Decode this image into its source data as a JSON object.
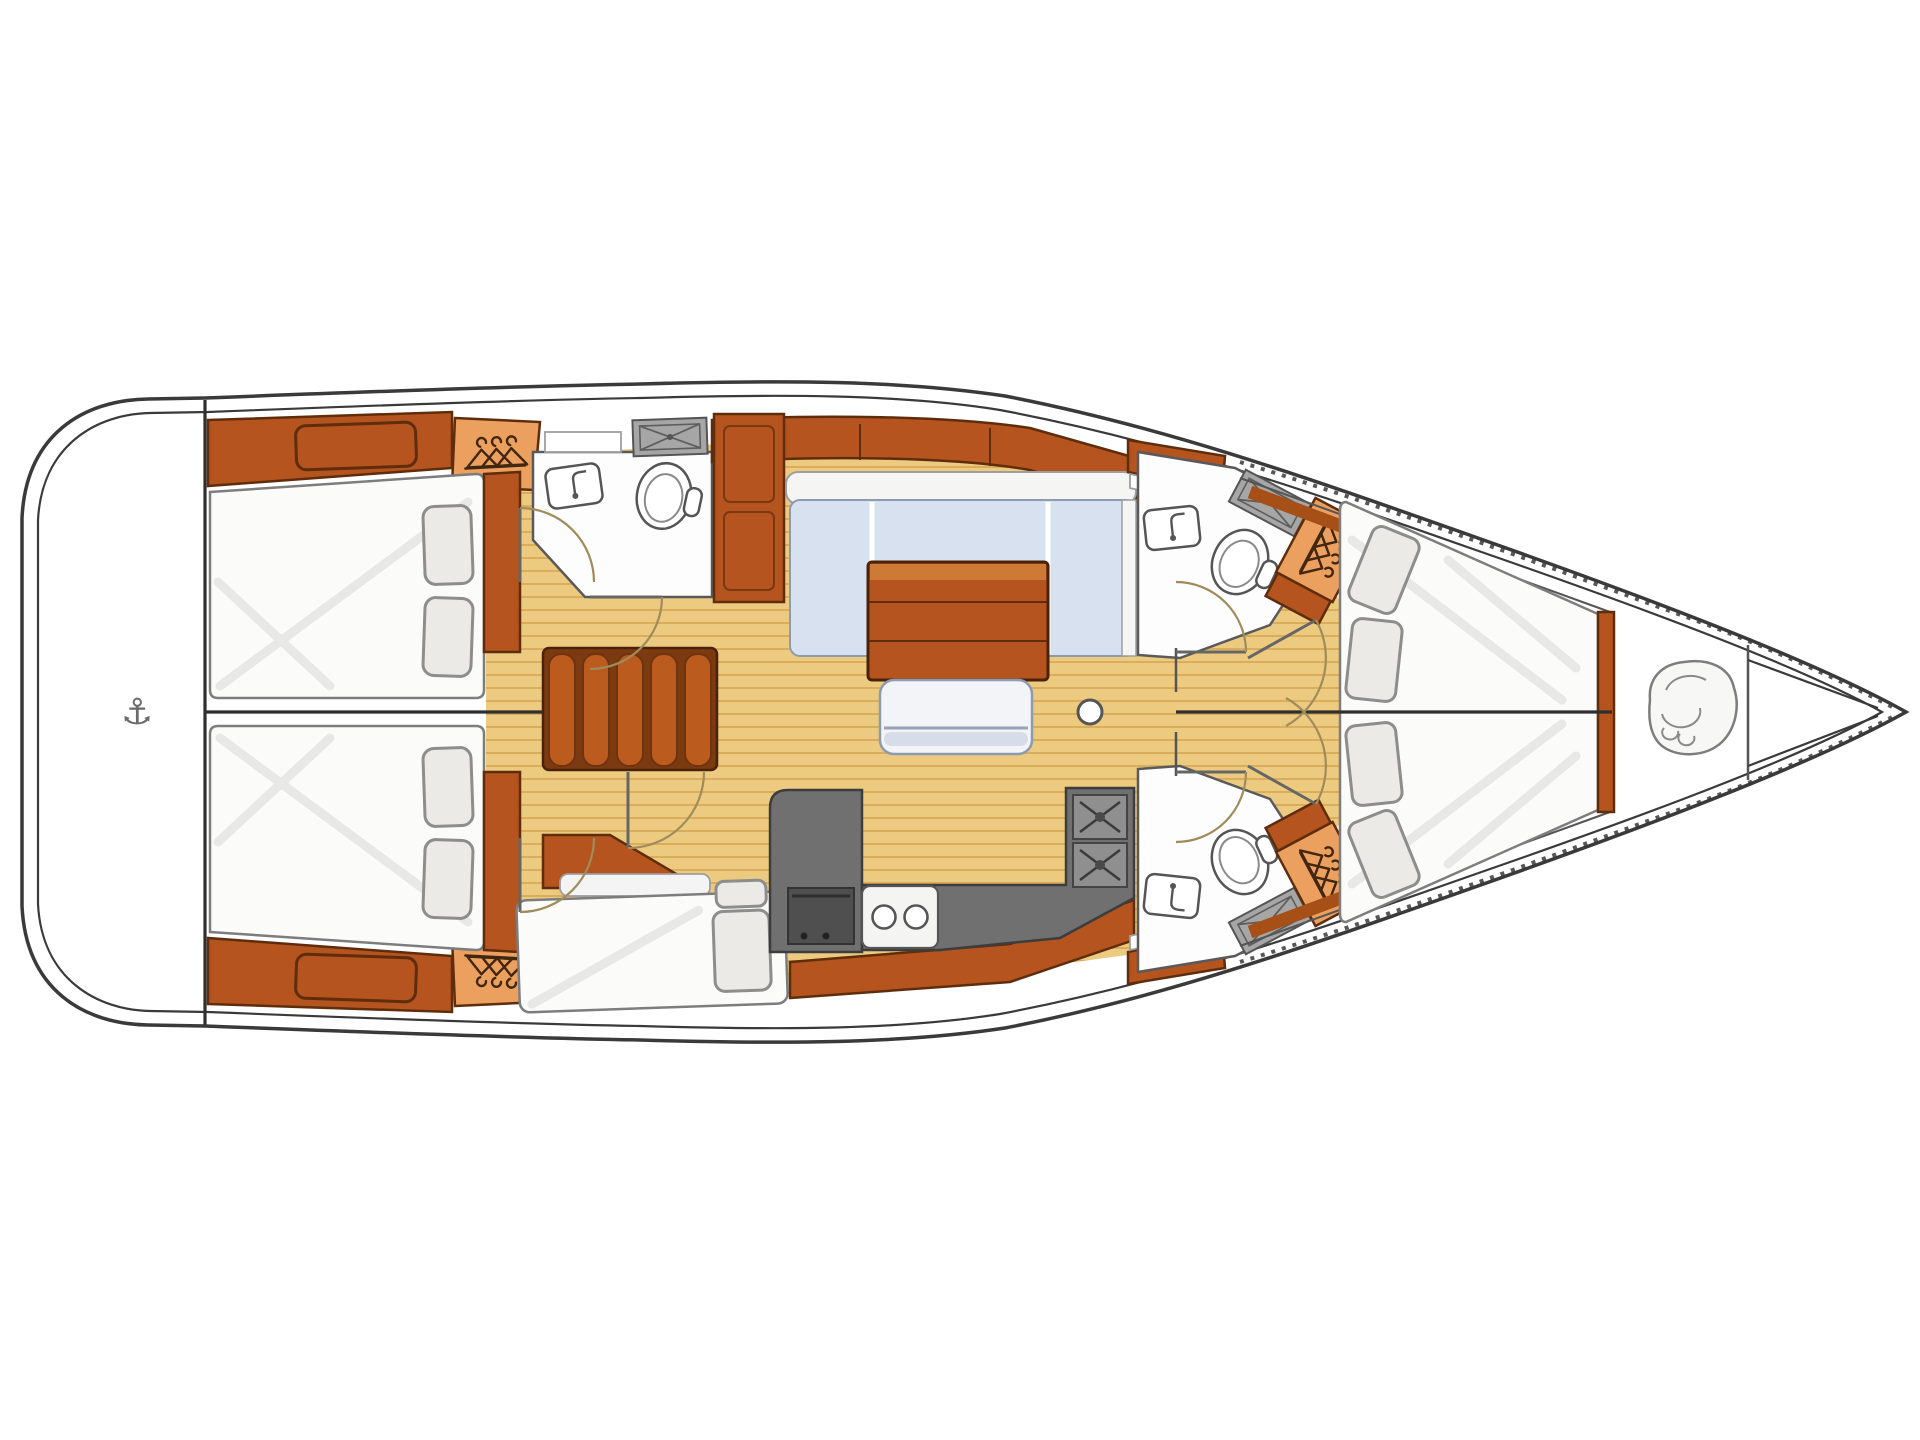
{
  "diagram": {
    "kind": "sailboat-interior-floor-plan",
    "orientation": {
      "bow": "right",
      "stern": "left"
    }
  },
  "palette": {
    "white": "#ffffff",
    "outline": "#3a3a3a",
    "lineDark": "#2f2f2f",
    "floor": "#ecca80",
    "floorStripe": "#d9ad5c",
    "wood": "#b5541e",
    "woodDark": "#5f2d0c",
    "woodDeep": "#8a3c10",
    "woodLight": "#eba05f",
    "woodPale": "#cd7a36",
    "bedSheet": "#fbfbfa",
    "bedShade": "#e8e8e6",
    "pillow": "#eceae6",
    "pillowStroke": "#8d8d8d",
    "sofa": "#d8e1ef",
    "sofaEdge": "#8d9bb0",
    "counter": "#707070",
    "grate": "#a6a6a6",
    "doorArc": "#a08c5a"
  },
  "icons": {
    "anchor": "⚓",
    "hanger": "clothes-hanger",
    "rope_coil": "anchor-rode-coil",
    "faucet": "sink-faucet"
  },
  "rooms": [
    {
      "name": "swim-platform",
      "features": [
        "anchor-icon"
      ]
    },
    {
      "name": "aft-cabin-port",
      "features": [
        "double-bed",
        "wardrobe",
        "hanging-locker"
      ],
      "pillows": 2
    },
    {
      "name": "aft-cabin-starboard",
      "features": [
        "double-bed",
        "wardrobe",
        "hanging-locker"
      ],
      "pillows": 2
    },
    {
      "name": "aft-head-port",
      "features": [
        "toilet",
        "sink",
        "shower-grate",
        "counter"
      ]
    },
    {
      "name": "companionway",
      "steps": 5
    },
    {
      "name": "crew-berth-starboard",
      "features": [
        "single-berth",
        "seat-cushion"
      ],
      "pillows": 1
    },
    {
      "name": "salon",
      "features": [
        "l-shaped-sofa",
        "wood-table",
        "bench-seat",
        "mast-post",
        "sideboard-cabinet"
      ]
    },
    {
      "name": "galley",
      "features": [
        "l-counter",
        "double-sink",
        "two-burner-stove",
        "oven"
      ]
    },
    {
      "name": "forward-head-port",
      "features": [
        "toilet",
        "sink",
        "shower-grate",
        "hanging-locker"
      ]
    },
    {
      "name": "forward-head-starboard",
      "features": [
        "toilet",
        "sink",
        "shower-grate",
        "hanging-locker"
      ]
    },
    {
      "name": "forward-cabin",
      "features": [
        "v-berth"
      ],
      "pillows": 4
    },
    {
      "name": "anchor-locker",
      "features": [
        "rope-coil-icon"
      ]
    }
  ]
}
